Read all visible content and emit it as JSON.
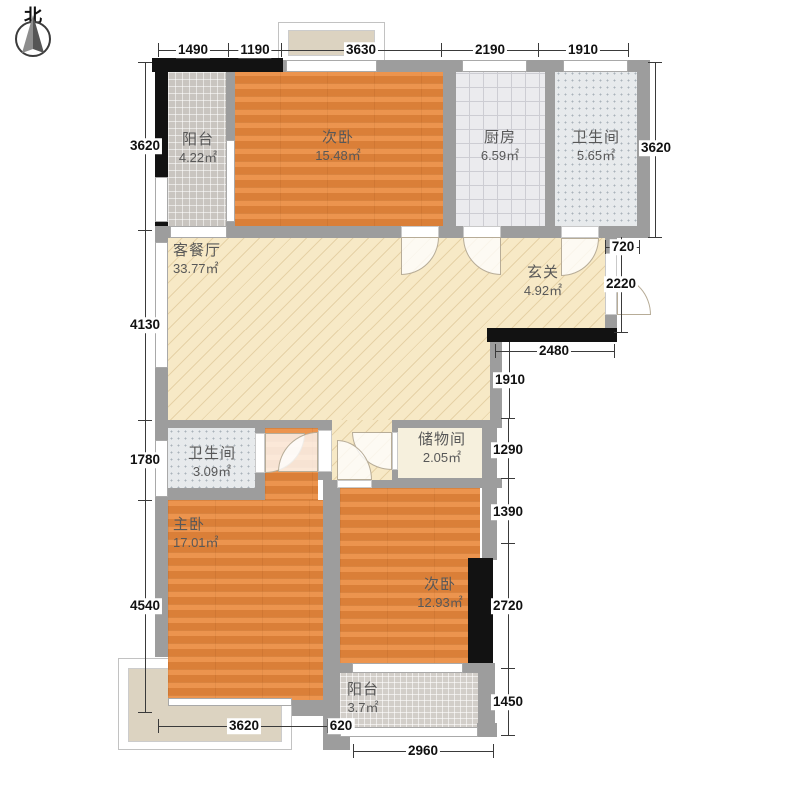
{
  "compass": {
    "north_label": "北"
  },
  "rooms": [
    {
      "id": "balcony-north",
      "name": "阳台",
      "area": "4.22㎡"
    },
    {
      "id": "bedroom-north",
      "name": "次卧",
      "area": "15.48㎡"
    },
    {
      "id": "kitchen",
      "name": "厨房",
      "area": "6.59㎡"
    },
    {
      "id": "bathroom-north",
      "name": "卫生间",
      "area": "5.65㎡"
    },
    {
      "id": "living-dining",
      "name": "客餐厅",
      "area": "33.77㎡"
    },
    {
      "id": "foyer",
      "name": "玄关",
      "area": "4.92㎡"
    },
    {
      "id": "bathroom-south",
      "name": "卫生间",
      "area": "3.09㎡"
    },
    {
      "id": "storage",
      "name": "储物间",
      "area": "2.05㎡"
    },
    {
      "id": "master-bedroom",
      "name": "主卧",
      "area": "17.01㎡"
    },
    {
      "id": "bedroom-south",
      "name": "次卧",
      "area": "12.93㎡"
    },
    {
      "id": "balcony-south",
      "name": "阳台",
      "area": "3.7㎡"
    }
  ],
  "dims": {
    "top": [
      "1490",
      "1190",
      "3630",
      "2190",
      "1910"
    ],
    "left": [
      "3620",
      "4130",
      "1780",
      "4540"
    ],
    "right": [
      "3620",
      "720",
      "2220",
      "2480",
      "1910",
      "1290",
      "1390",
      "2720",
      "1450"
    ],
    "bottom": [
      "3620",
      "620",
      "2960"
    ]
  },
  "colors": {
    "wall": "#9d9d9d",
    "wall_accent": "#121212",
    "wood_floor": "#e8873c",
    "living_floor": "#f7e9c6",
    "kitchen_floor": "#ebebee",
    "bath_floor": "#e7eaec",
    "balcony_floor": "#c9c5c0",
    "bay_window_fill": "#dcd3c1",
    "dimension_text": "#111111",
    "room_label_text": "#585858"
  }
}
